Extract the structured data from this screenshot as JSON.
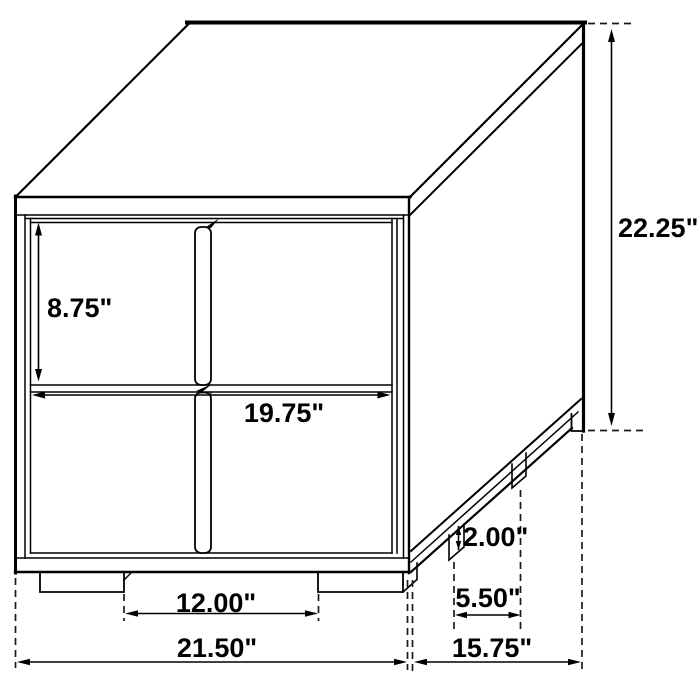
{
  "page": {
    "background": "#ffffff"
  },
  "diagram": {
    "subject": "two-drawer nightstand dimension drawing",
    "line_color": "#000000",
    "labels": {
      "drawer_opening_height": "8.75\"",
      "overall_height": "22.25\"",
      "drawer_width": "19.75\"",
      "leg_height": "2.00\"",
      "side_leg_spacing": "5.50\"",
      "front_leg_spacing": "12.00\"",
      "overall_width": "21.50\"",
      "overall_depth": "15.75\""
    }
  }
}
